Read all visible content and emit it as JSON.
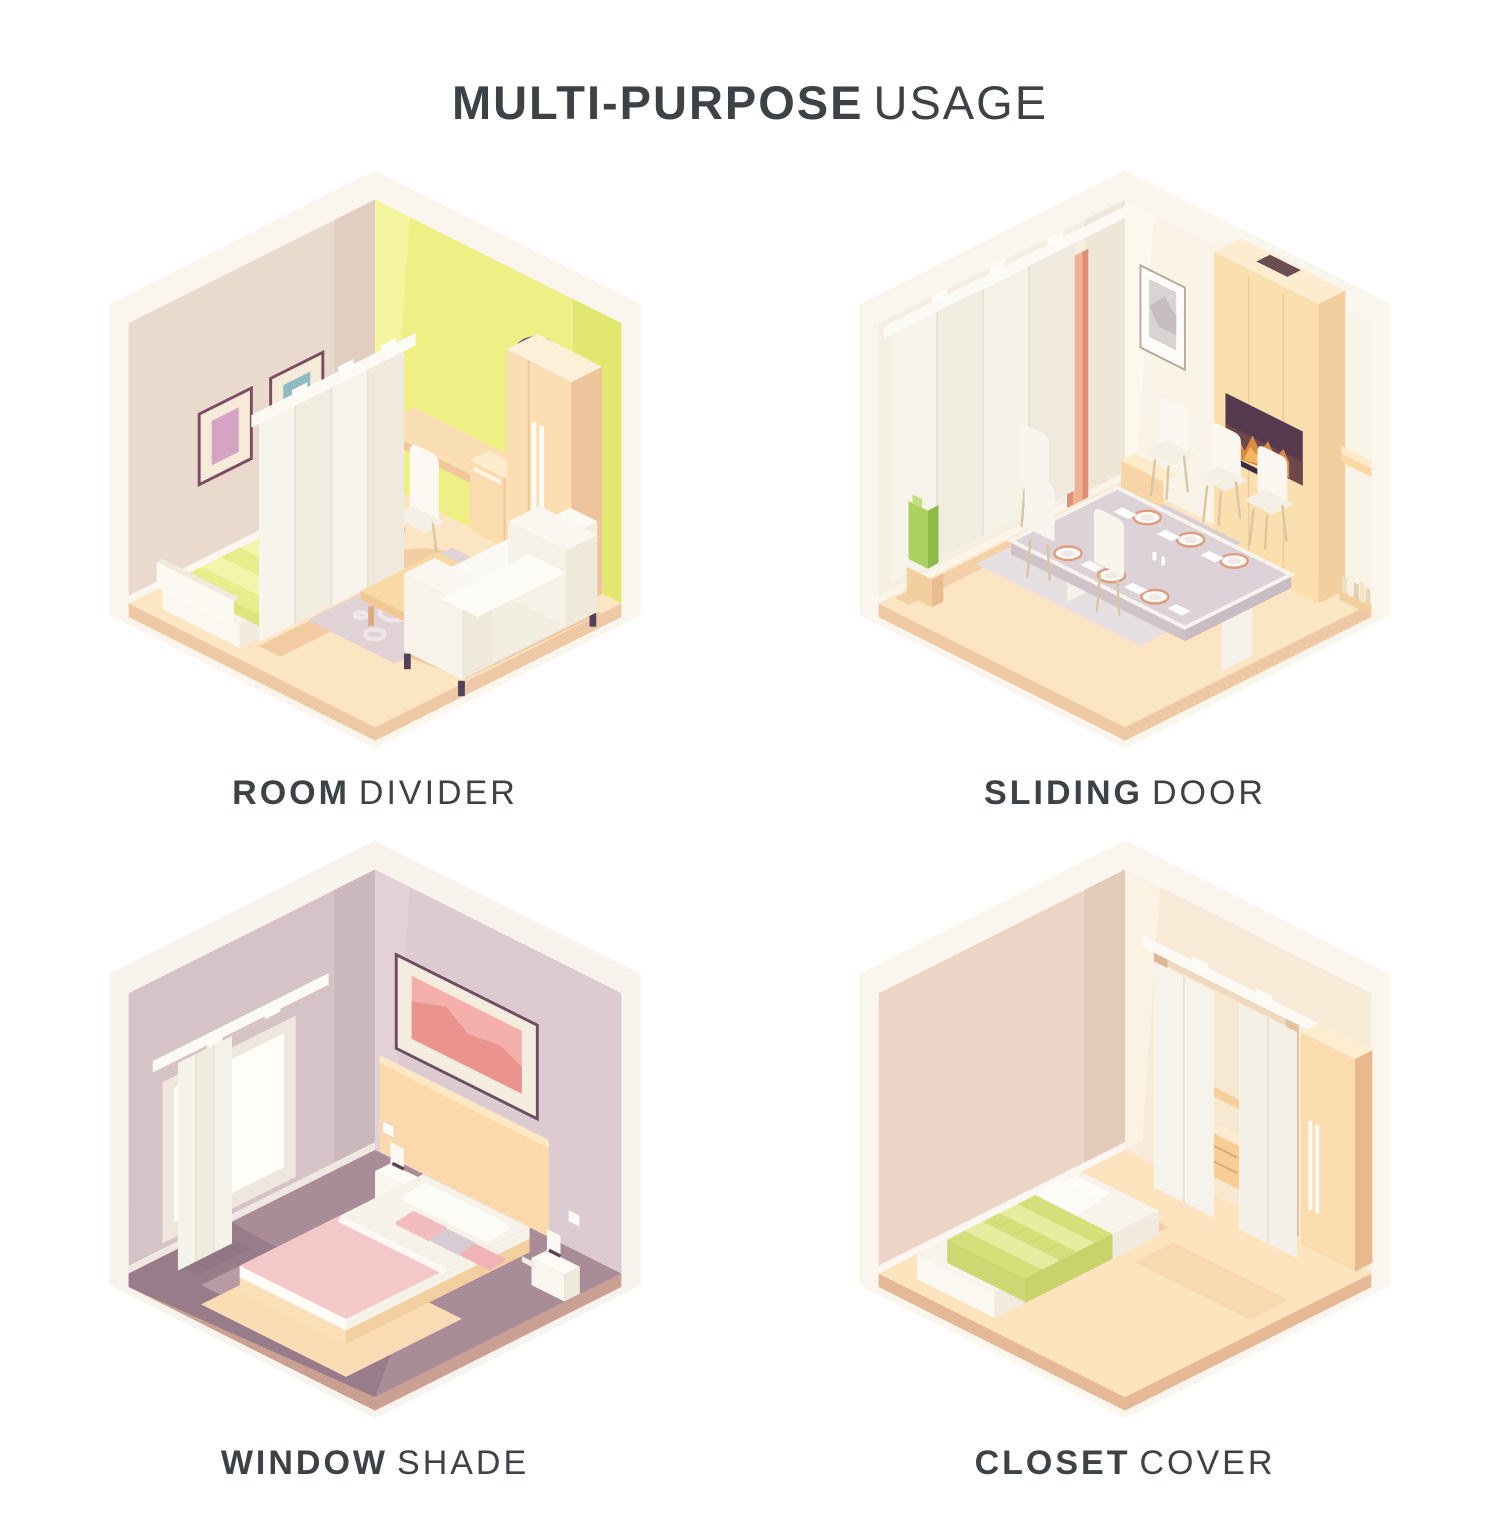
{
  "title": {
    "bold": "MULTI-PURPOSE",
    "light": "USAGE"
  },
  "tiles": [
    {
      "id": "room-divider",
      "label_bold": "ROOM",
      "label_light": "DIVIDER",
      "scene": "bedroom and living room separated by a white panel curtain divider"
    },
    {
      "id": "sliding-door",
      "label_bold": "SLIDING",
      "label_light": "DOOR",
      "scene": "dining room with panel curtain used as a sliding door beside fireplace and dining set"
    },
    {
      "id": "window-shade",
      "label_bold": "WINDOW",
      "label_light": "SHADE",
      "scene": "bedroom with panel curtain used as a shade over a bright window"
    },
    {
      "id": "closet-cover",
      "label_bold": "CLOSET",
      "label_light": "COVER",
      "scene": "bedroom with panel curtains covering a closet opening next to a wardrobe"
    }
  ],
  "colors": {
    "text": "#3d4247",
    "background": "#ffffff",
    "curtain_white": "#f5f2ea",
    "rail_white": "#fcfaf4",
    "floor_peach": "#fce5c2",
    "floor_plum": "#aa8d99",
    "wall_beige": "#ead9cd",
    "wall_yellow": "#eef086",
    "wall_cream": "#f6eee1",
    "wall_mauve": "#d6c3c7",
    "wood_peach": "#fbdfb2",
    "accent_salmon": "#dd9076",
    "plant_green": "#aad05e",
    "blanket_green": "#dbe381",
    "blanket_pink": "#f4c8c8",
    "clock_plum": "#7c5168",
    "frame_pink": "#d5a3c3",
    "frame_teal": "#8fbcc2",
    "fire_orange": "#d98a41"
  }
}
